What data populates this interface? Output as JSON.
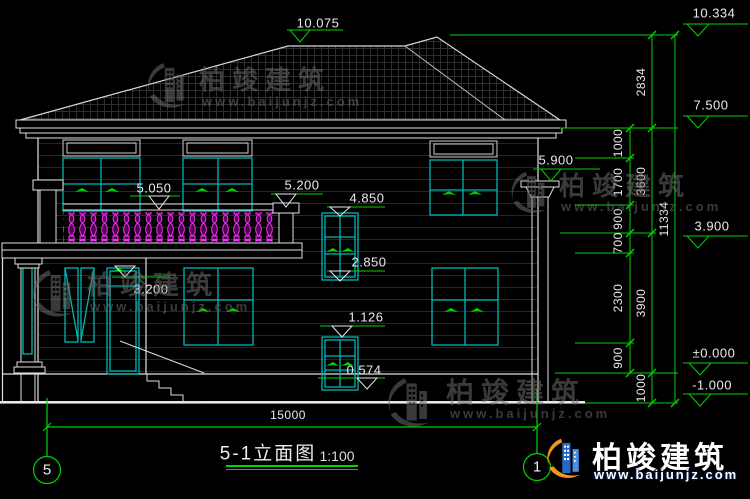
{
  "titleblock": {
    "title": "5-1立面图",
    "scale": "1:100"
  },
  "grid": {
    "left_bubble": "5",
    "right_bubble": "1"
  },
  "dimensions": {
    "overall_width": "15000",
    "overall_height": "11334",
    "roof_height": "2834",
    "upper_floor": "3600",
    "lower_floor": "3900",
    "plinth": "1000",
    "segments": {
      "s1": "1000",
      "s2": "1700",
      "s3": "900",
      "s4": "700",
      "s5": "2300",
      "s6": "900"
    }
  },
  "elevations": {
    "ridge_left": "10.075",
    "ridge_right": "10.334",
    "eave": "7.500",
    "column_capital": "5.900",
    "balcony_rail": "5.050",
    "balcony_pier": "5.200",
    "window_a_head": "4.850",
    "level_390": "3.900",
    "door_head": "3.200",
    "window_a_sill": "2.850",
    "window_b_head": "1.126",
    "window_b_sill": "0.574",
    "ground": "±0.000",
    "site": "-1.000"
  },
  "watermark": {
    "brand": "柏竣建筑",
    "url": "www.baijunjz.com"
  },
  "logo": {
    "brand": "柏竣建筑",
    "url": "www.baijunjz.com"
  },
  "colors": {
    "dimension_green": "#00d400",
    "window_cyan": "#00b6b6",
    "baluster_magenta": "#ff2bff",
    "line_white": "#e8e8e8",
    "logo_blue": "#2468c8",
    "logo_orange": "#f7941d"
  }
}
